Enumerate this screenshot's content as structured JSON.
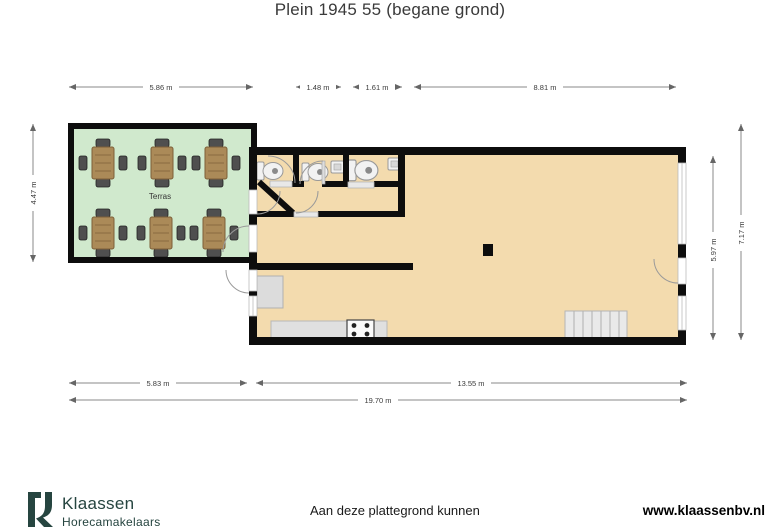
{
  "title": "Plein 1945 55 (begane grond)",
  "plan": {
    "terrace_label": "Terras",
    "dimensions": {
      "top_terrace": "5.86 m",
      "top_wc1": "1.48 m",
      "top_wc2": "1.61 m",
      "top_main": "8.81 m",
      "left_terrace": "4.47 m",
      "right_inner": "5.97 m",
      "right_outer": "7.17 m",
      "bottom_left": "5.83 m",
      "bottom_right": "13.55 m",
      "bottom_total": "19.70 m"
    },
    "colors": {
      "terrace_floor": "#d0e9cd",
      "building_floor": "#f3dbae",
      "walls": "#0d0d0d",
      "table_wood": "#ab8a58",
      "logo": "#264540"
    }
  },
  "footer": {
    "brand": "Klaassen",
    "brand_subtitle": "Horecamakelaars",
    "disclaimer": "Aan deze plattegrond kunnen",
    "website": "www.klaassenbv.nl"
  }
}
